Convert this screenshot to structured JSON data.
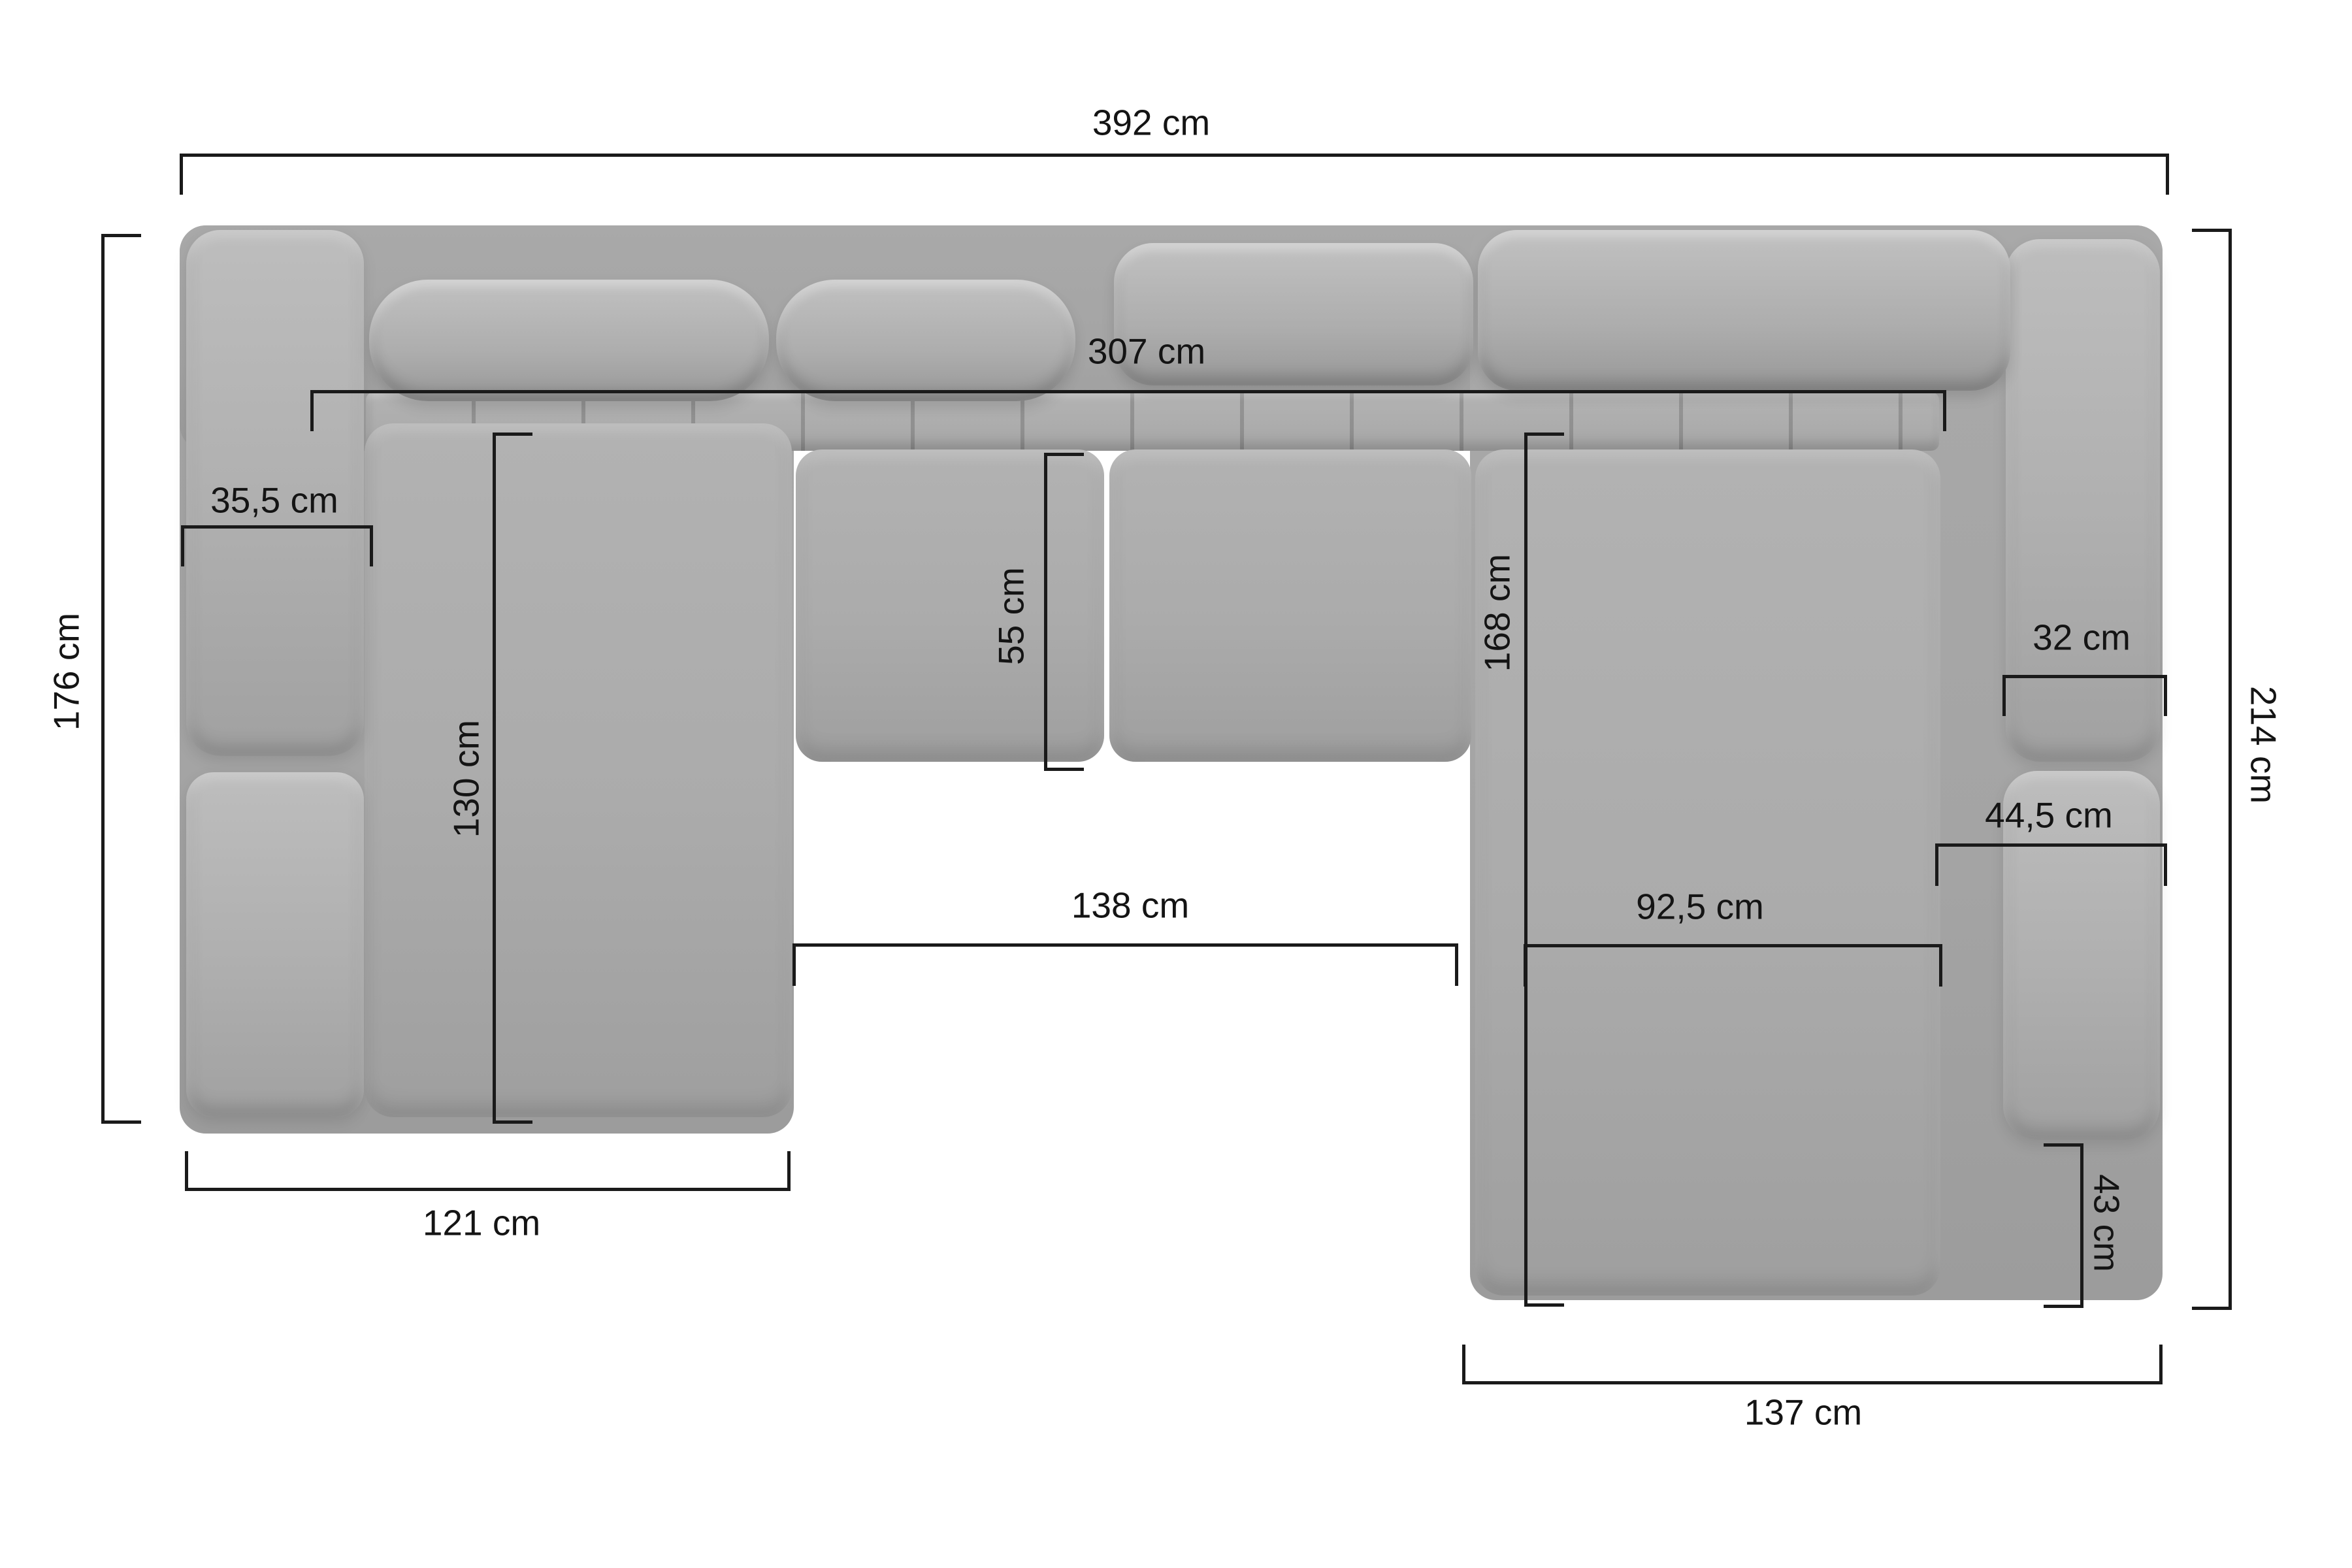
{
  "colors": {
    "background": "#ffffff",
    "sofa_base_gray": "#a4a4a4",
    "sofa_cushion_gray": "#b0b0b0",
    "dimension_line": "#1a1a1a",
    "label_text": "#141414"
  },
  "dimensions": {
    "total_width": "392 cm",
    "back_width": "307 cm",
    "left_armrest_width": "35,5 cm",
    "left_section_depth": "176 cm",
    "middle_seat_depth": "55 cm",
    "left_chaise_length": "130 cm",
    "left_chaise_width": "121 cm",
    "right_chaise_length": "168 cm",
    "right_armrest_width": "32 cm",
    "right_section_depth": "214 cm",
    "right_chaise_armrest_width": "44,5 cm",
    "inner_gap_width": "138 cm",
    "right_corner_seat_width": "92,5 cm",
    "right_armrest_rear_depth": "43 cm",
    "right_chaise_width": "137 cm"
  }
}
